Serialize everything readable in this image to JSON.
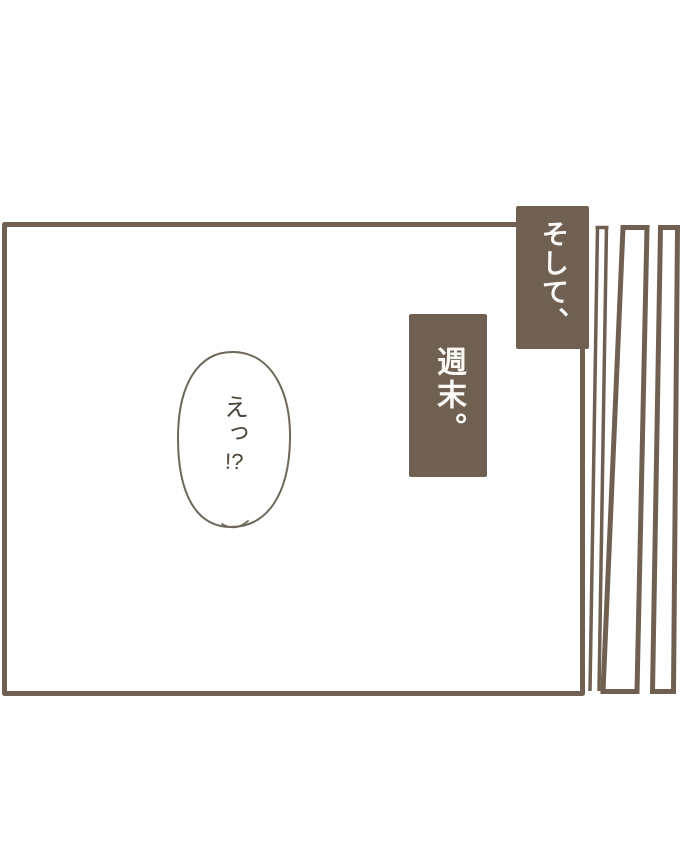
{
  "scene": {
    "type": "comic-panel",
    "background_color": "#ffffff",
    "ink_color": "#6f6052",
    "caption_background_color": "#6f6052",
    "caption_text_color": "#faf9f6",
    "bubble_stroke_color": "#6e675b",
    "bubble_text_color": "#4e463c"
  },
  "captions": [
    {
      "text": "そして、"
    },
    {
      "text": "週末。"
    }
  ],
  "speech_bubble": {
    "line1": "えっ",
    "line2": "!?"
  }
}
